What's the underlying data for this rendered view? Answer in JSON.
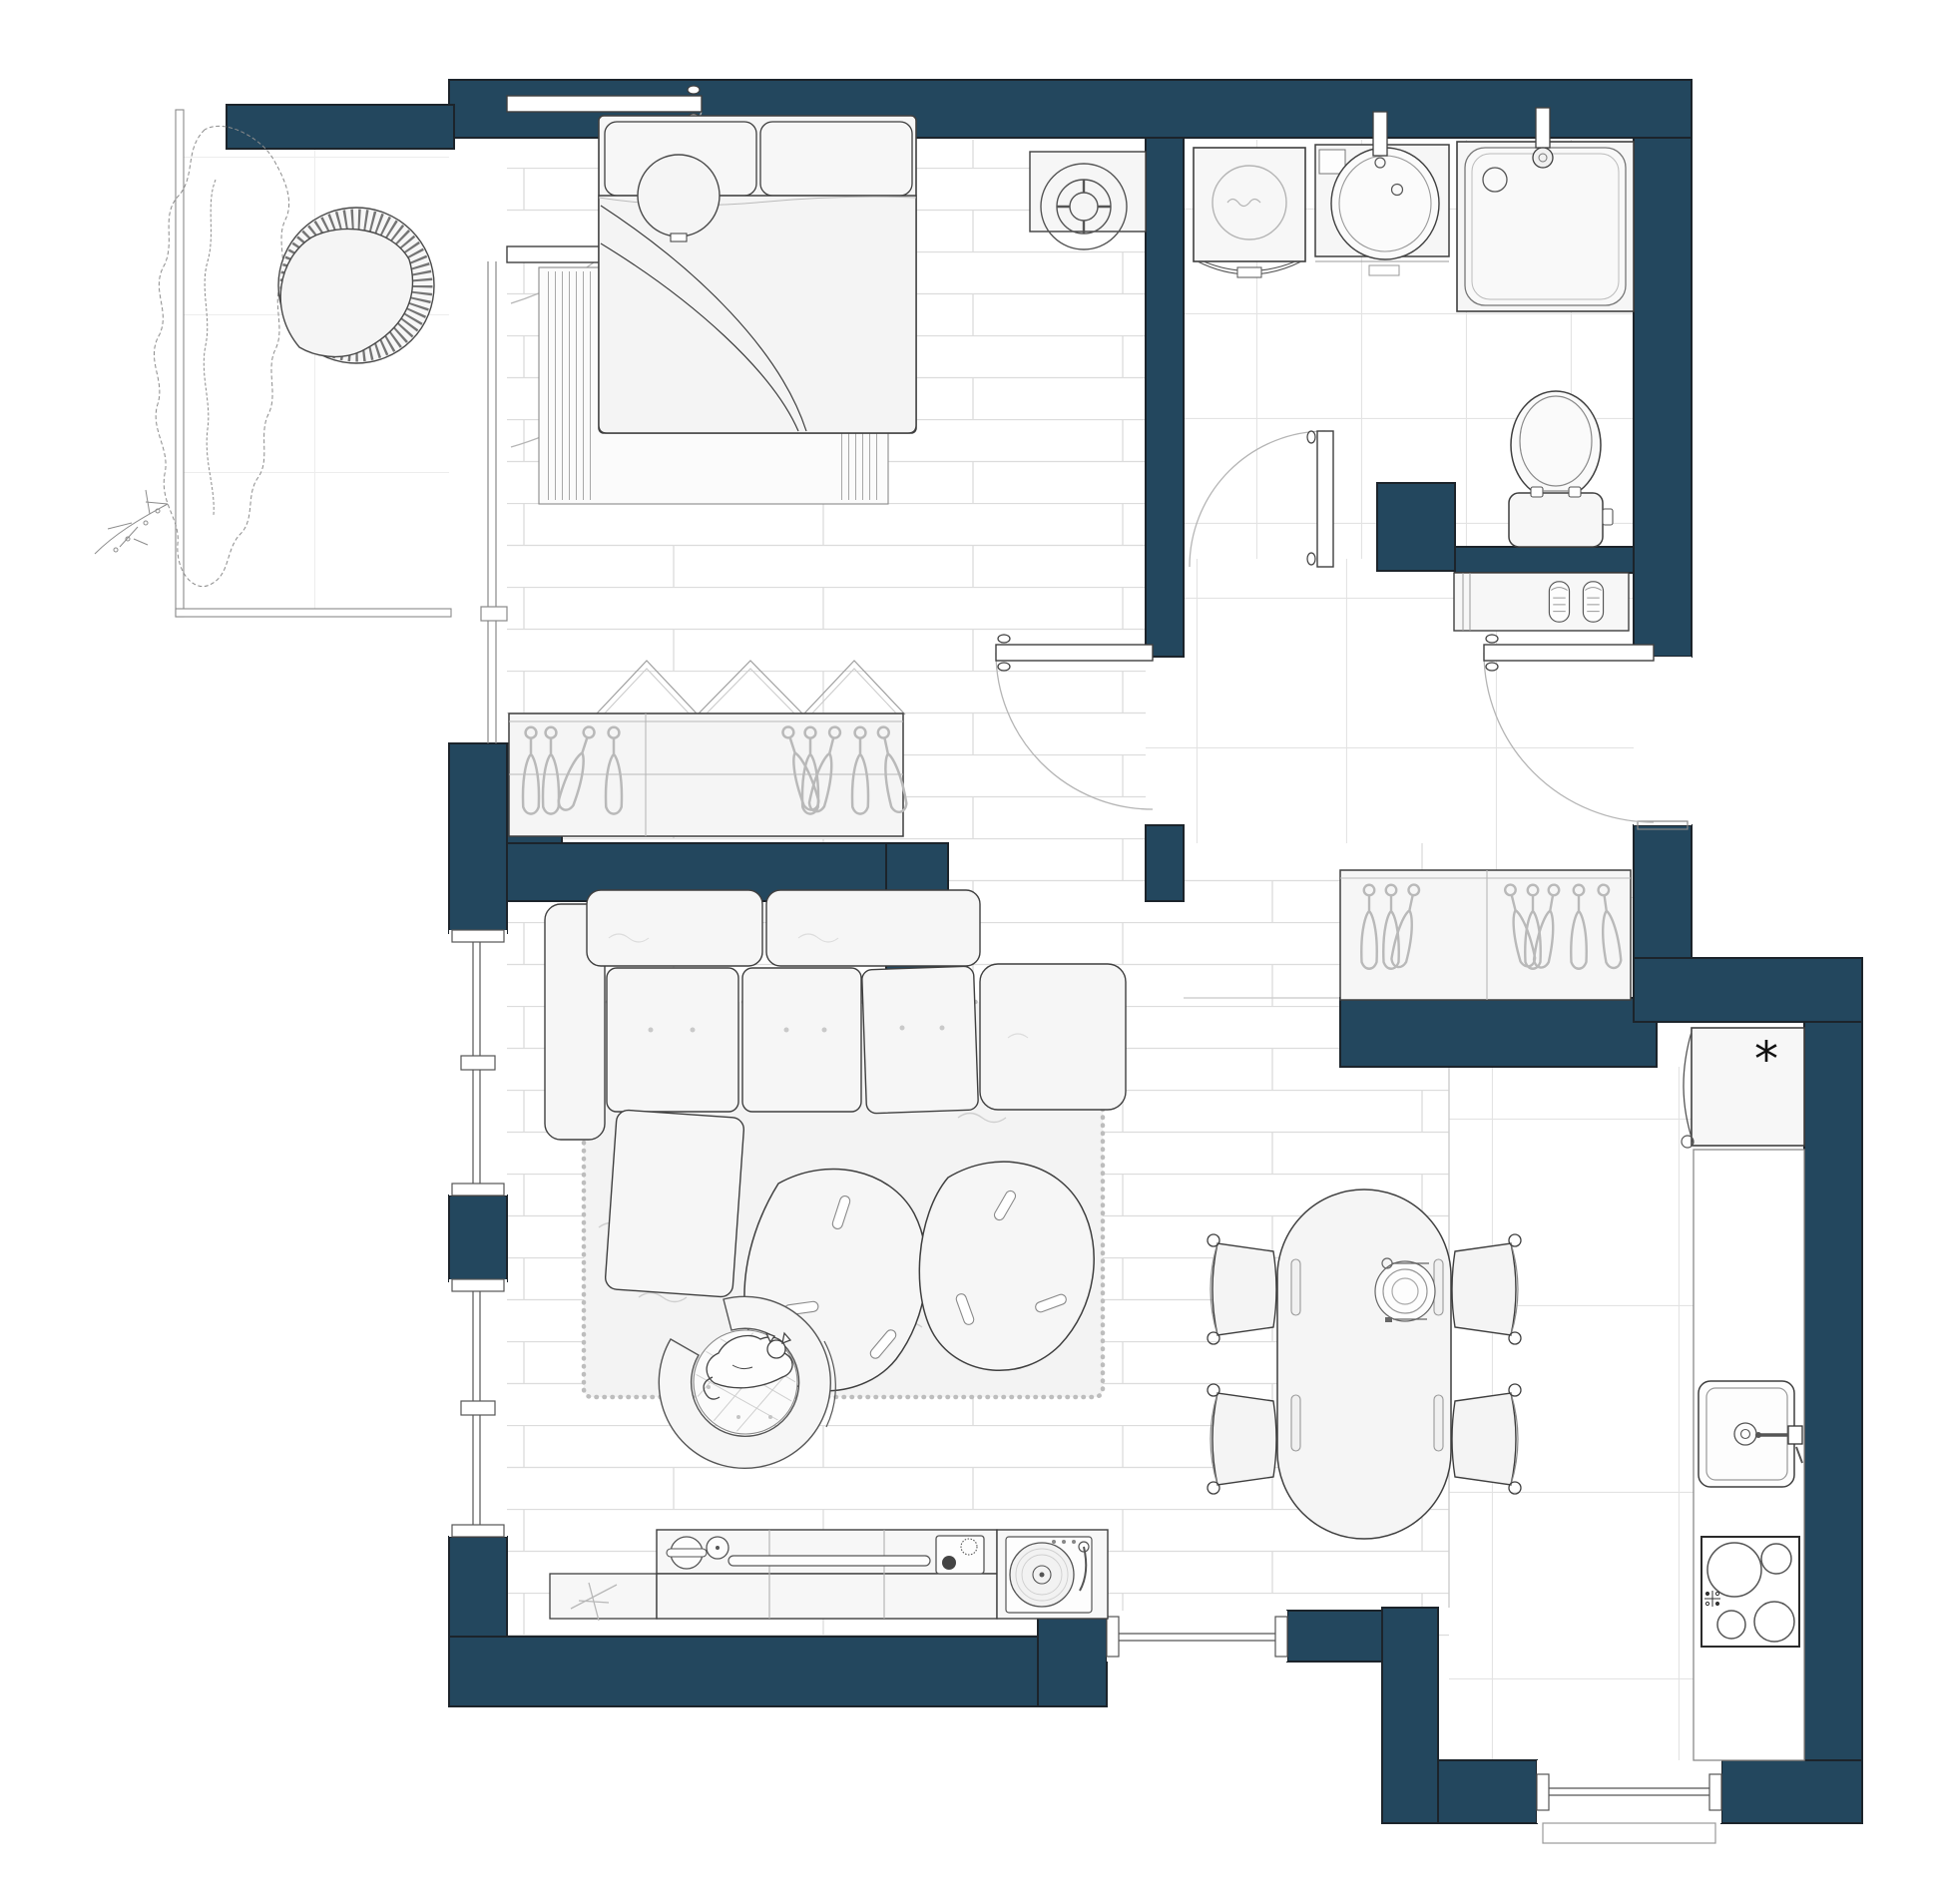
{
  "document": {
    "title": "Apartment floor plan — top view architectural drawing",
    "style": "2D CAD floor plan, dark blue walls, white floors with light joint lines"
  },
  "colors": {
    "wall": "#23475e",
    "wall_outline": "#1c242b",
    "furniture_fill": "#f6f6f6",
    "furniture_stroke": "#3f3f3f",
    "sketch": "#a9a9a9",
    "floor_line": "#dcdcdc",
    "rug_border": "#bdbdbd",
    "background": "#ffffff"
  },
  "kitchen": {
    "fridge_symbol": "*"
  },
  "rooms": [
    {
      "name": "balcony",
      "items": [
        "shrub planter sketch",
        "round rattan lounge chair",
        "railing"
      ]
    },
    {
      "name": "bedroom",
      "items": [
        "double bed with two pillows and folded duvet",
        "fringed rug under bed",
        "round side table",
        "side table with fan",
        "wardrobe with clothes hangers and bi-fold doors",
        "french doors to balcony",
        "hinged door to hallway"
      ]
    },
    {
      "name": "bathroom",
      "items": [
        "washing machine",
        "vanity with oval basin and faucet",
        "walk-in shower with drain and shower head",
        "toilet with cistern",
        "half-wall partition"
      ]
    },
    {
      "name": "hallway",
      "items": [
        "shoe cabinet with pair of shoes",
        "entrance door with swing arc",
        "built-in coat wardrobe with hangers",
        "bathroom door with swing arc"
      ]
    },
    {
      "name": "living-room",
      "items": [
        "corner sofa with chaise and bench cushion",
        "two pebble-shaped coffee tables",
        "shaggy rug",
        "round pet bed with sleeping cat",
        "tv sideboard with bowls, soundbar, receiver and record player",
        "shelf section with plant sketch"
      ]
    },
    {
      "name": "dining-area",
      "items": [
        "oval dining table",
        "four chairs with curled backrests",
        "place setting with plate and cutlery"
      ]
    },
    {
      "name": "kitchen",
      "items": [
        "refrigerator marked with asterisk",
        "counter run along right wall",
        "square sink with wall-mounted faucet",
        "four-burner cooktop"
      ]
    }
  ],
  "openings": {
    "windows": 5,
    "interior_doors": 3,
    "entrance_doors": 1,
    "balcony_doors": 2
  }
}
